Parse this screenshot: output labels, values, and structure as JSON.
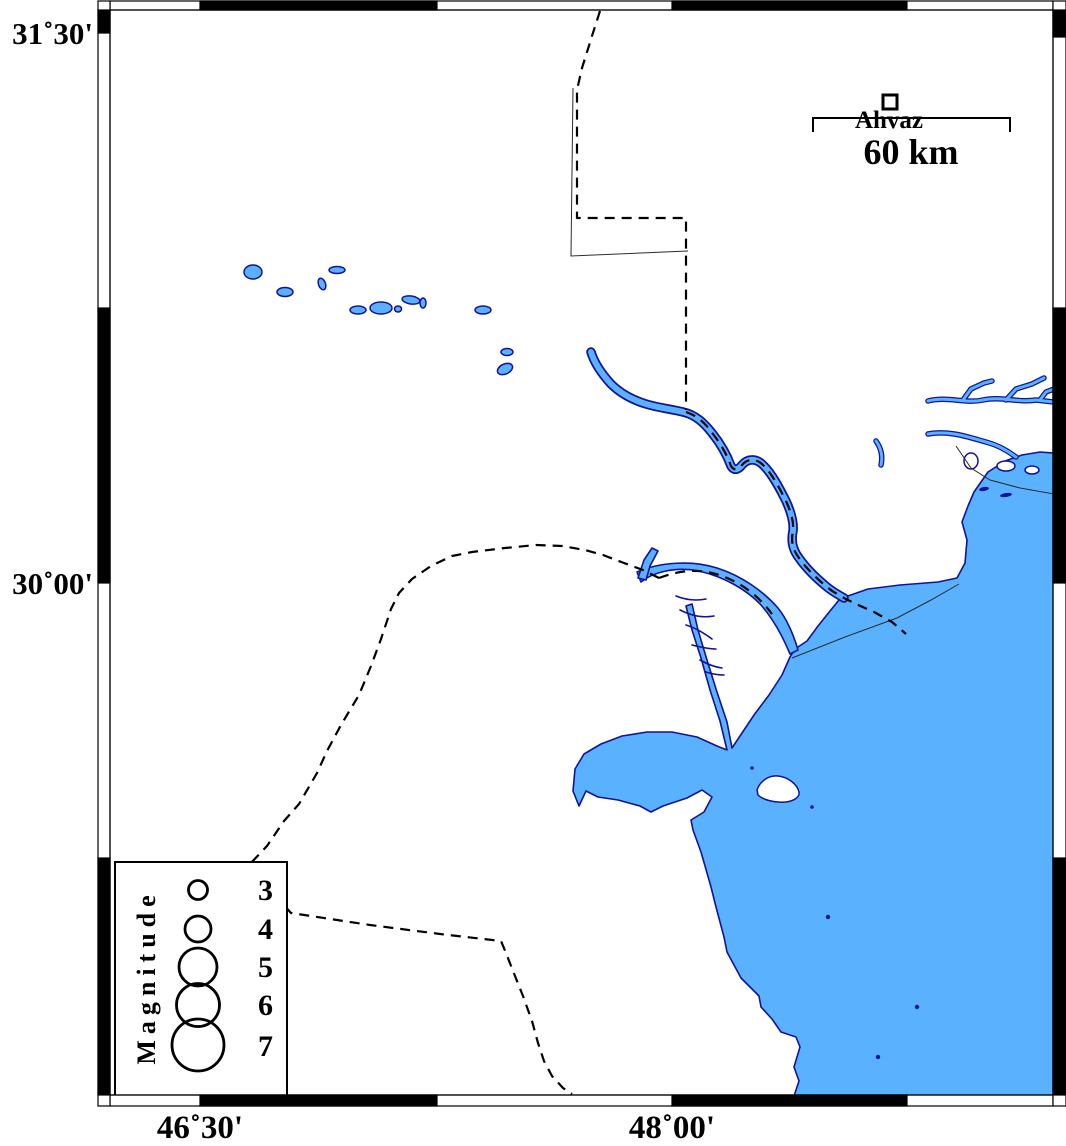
{
  "axis": {
    "lat": [
      {
        "text": "31˚30'"
      },
      {
        "text": "30˚00'"
      }
    ],
    "lon": [
      {
        "text": "46˚30'"
      },
      {
        "text": "48˚00'"
      }
    ]
  },
  "city": {
    "name": "Ahvaz"
  },
  "scale_bar": {
    "label": "60 km"
  },
  "legend": {
    "title": "Magnitude",
    "items": [
      {
        "label": "3",
        "radius_px": 9.5
      },
      {
        "label": "4",
        "radius_px": 13
      },
      {
        "label": "5",
        "radius_px": 19
      },
      {
        "label": "6",
        "radius_px": 21.5
      },
      {
        "label": "7",
        "radius_px": 26
      }
    ]
  },
  "colors": {
    "water": "#5ab2ff",
    "coast": "#12129b",
    "land": "#ffffff",
    "frame": "#000000"
  }
}
